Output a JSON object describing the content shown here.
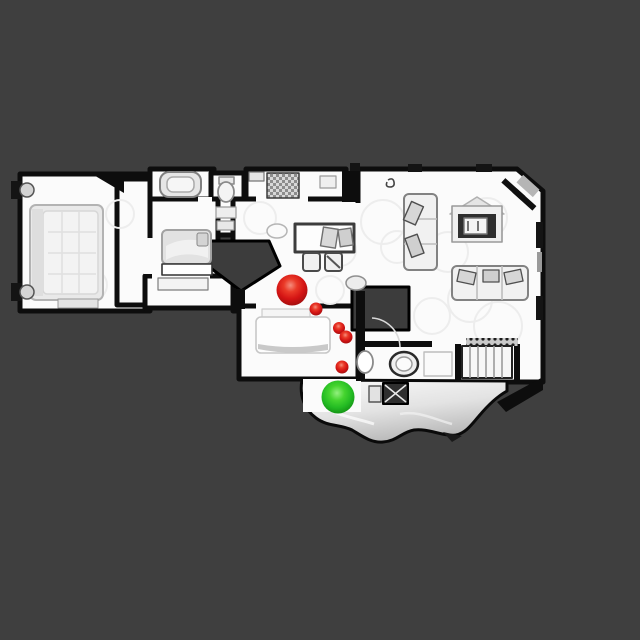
{
  "scene": {
    "view": "top-down",
    "canvas_width": 640,
    "canvas_height": 640
  },
  "colors": {
    "background": "#3f3f3f",
    "floor": "#fbfbfb",
    "walls": "#0d0d0d",
    "unscanned_interior": "#3c3c3c",
    "marker_red": "#d41414",
    "marker_red_highlight": "#f58d7d",
    "marker_red_shadow": "#6f0b0b",
    "marker_green": "#23bb23",
    "marker_green_highlight": "#93f07f",
    "marker_green_shadow": "#0c6e0c"
  },
  "waypoints": [
    {
      "id": "start",
      "role": "start",
      "color": "red",
      "x": 291.5,
      "y": 289.5,
      "r": 15.5
    },
    {
      "id": "path-1",
      "role": "path",
      "color": "red",
      "x": 315.5,
      "y": 308.5,
      "r": 6.5
    },
    {
      "id": "path-2",
      "role": "path",
      "color": "red",
      "x": 338.5,
      "y": 328.0,
      "r": 6.0
    },
    {
      "id": "path-3",
      "role": "path",
      "color": "red",
      "x": 346.0,
      "y": 336.5,
      "r": 6.5
    },
    {
      "id": "path-4",
      "role": "path",
      "color": "red",
      "x": 341.5,
      "y": 366.5,
      "r": 6.5
    },
    {
      "id": "goal",
      "role": "goal",
      "color": "green",
      "x": 337.5,
      "y": 396.5,
      "r": 16.5
    }
  ],
  "landmarks": [
    "master-bed",
    "nightstand-lamps",
    "bathtub",
    "toilet-upper",
    "guest-bed",
    "dressers",
    "pantry-shelf",
    "desk-with-chairs",
    "dining-table",
    "kitchen-island-unscanned",
    "sofa-left",
    "sofa-bottom",
    "fireplace",
    "stairs",
    "toilet-lower",
    "bath-oval",
    "mesh-blob-bottom"
  ]
}
